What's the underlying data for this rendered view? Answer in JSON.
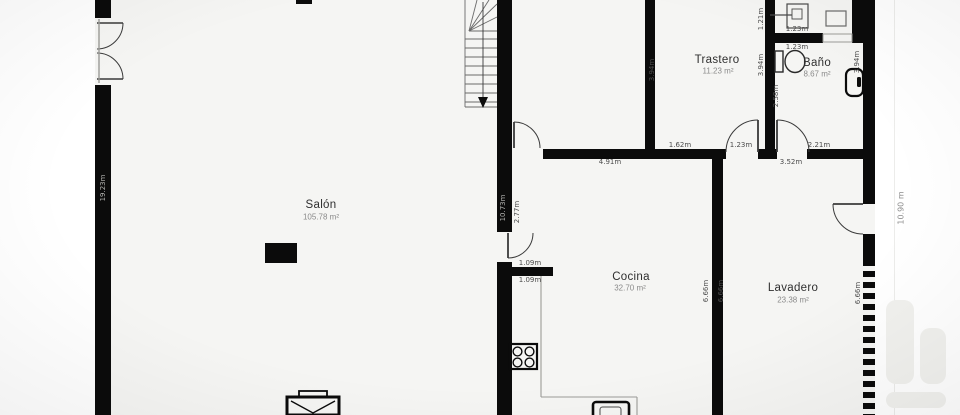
{
  "floorplan": {
    "rooms": {
      "salon": {
        "name": "Salón",
        "area": "105.78 m²"
      },
      "trastero": {
        "name": "Trastero",
        "area": "11.23 m²"
      },
      "bano": {
        "name": "Baño",
        "area": "8.67 m²"
      },
      "cocina": {
        "name": "Cocina",
        "area": "32.70 m²"
      },
      "lavadero": {
        "name": "Lavadero",
        "area": "23.38 m²"
      }
    },
    "dimensions": {
      "hall_wall": "4.91m",
      "trastero_bottom": "1.62m",
      "trastero_door": "1.23m",
      "bano_door": "2.21m",
      "lavadero_top": "3.52m",
      "aseo_inner_width": "1.23m",
      "bano_top_width": "1.23m",
      "trastero_left": "3.94m",
      "trastero_right": "3.94m",
      "bano_left": "2.58m",
      "bano_right": "3.94m",
      "aseo_left": "1.21m",
      "salon_right_wall": "10.73m",
      "cocina_upper_left": "2.77m",
      "salon_left_wall": "19.23m",
      "kitchen_stub_top": "1.09m",
      "kitchen_stub_bottom": "1.09m",
      "cocina_right": "6.66m",
      "lavadero_left": "6.66m",
      "lavadero_right": "6.66m",
      "overall_height": "10.90 m"
    },
    "colors": {
      "wall": "#0b0b0b",
      "floor": "#f5f5f3",
      "dim_text": "#4d4d4d",
      "wall_text": "#b3b3b0"
    }
  }
}
